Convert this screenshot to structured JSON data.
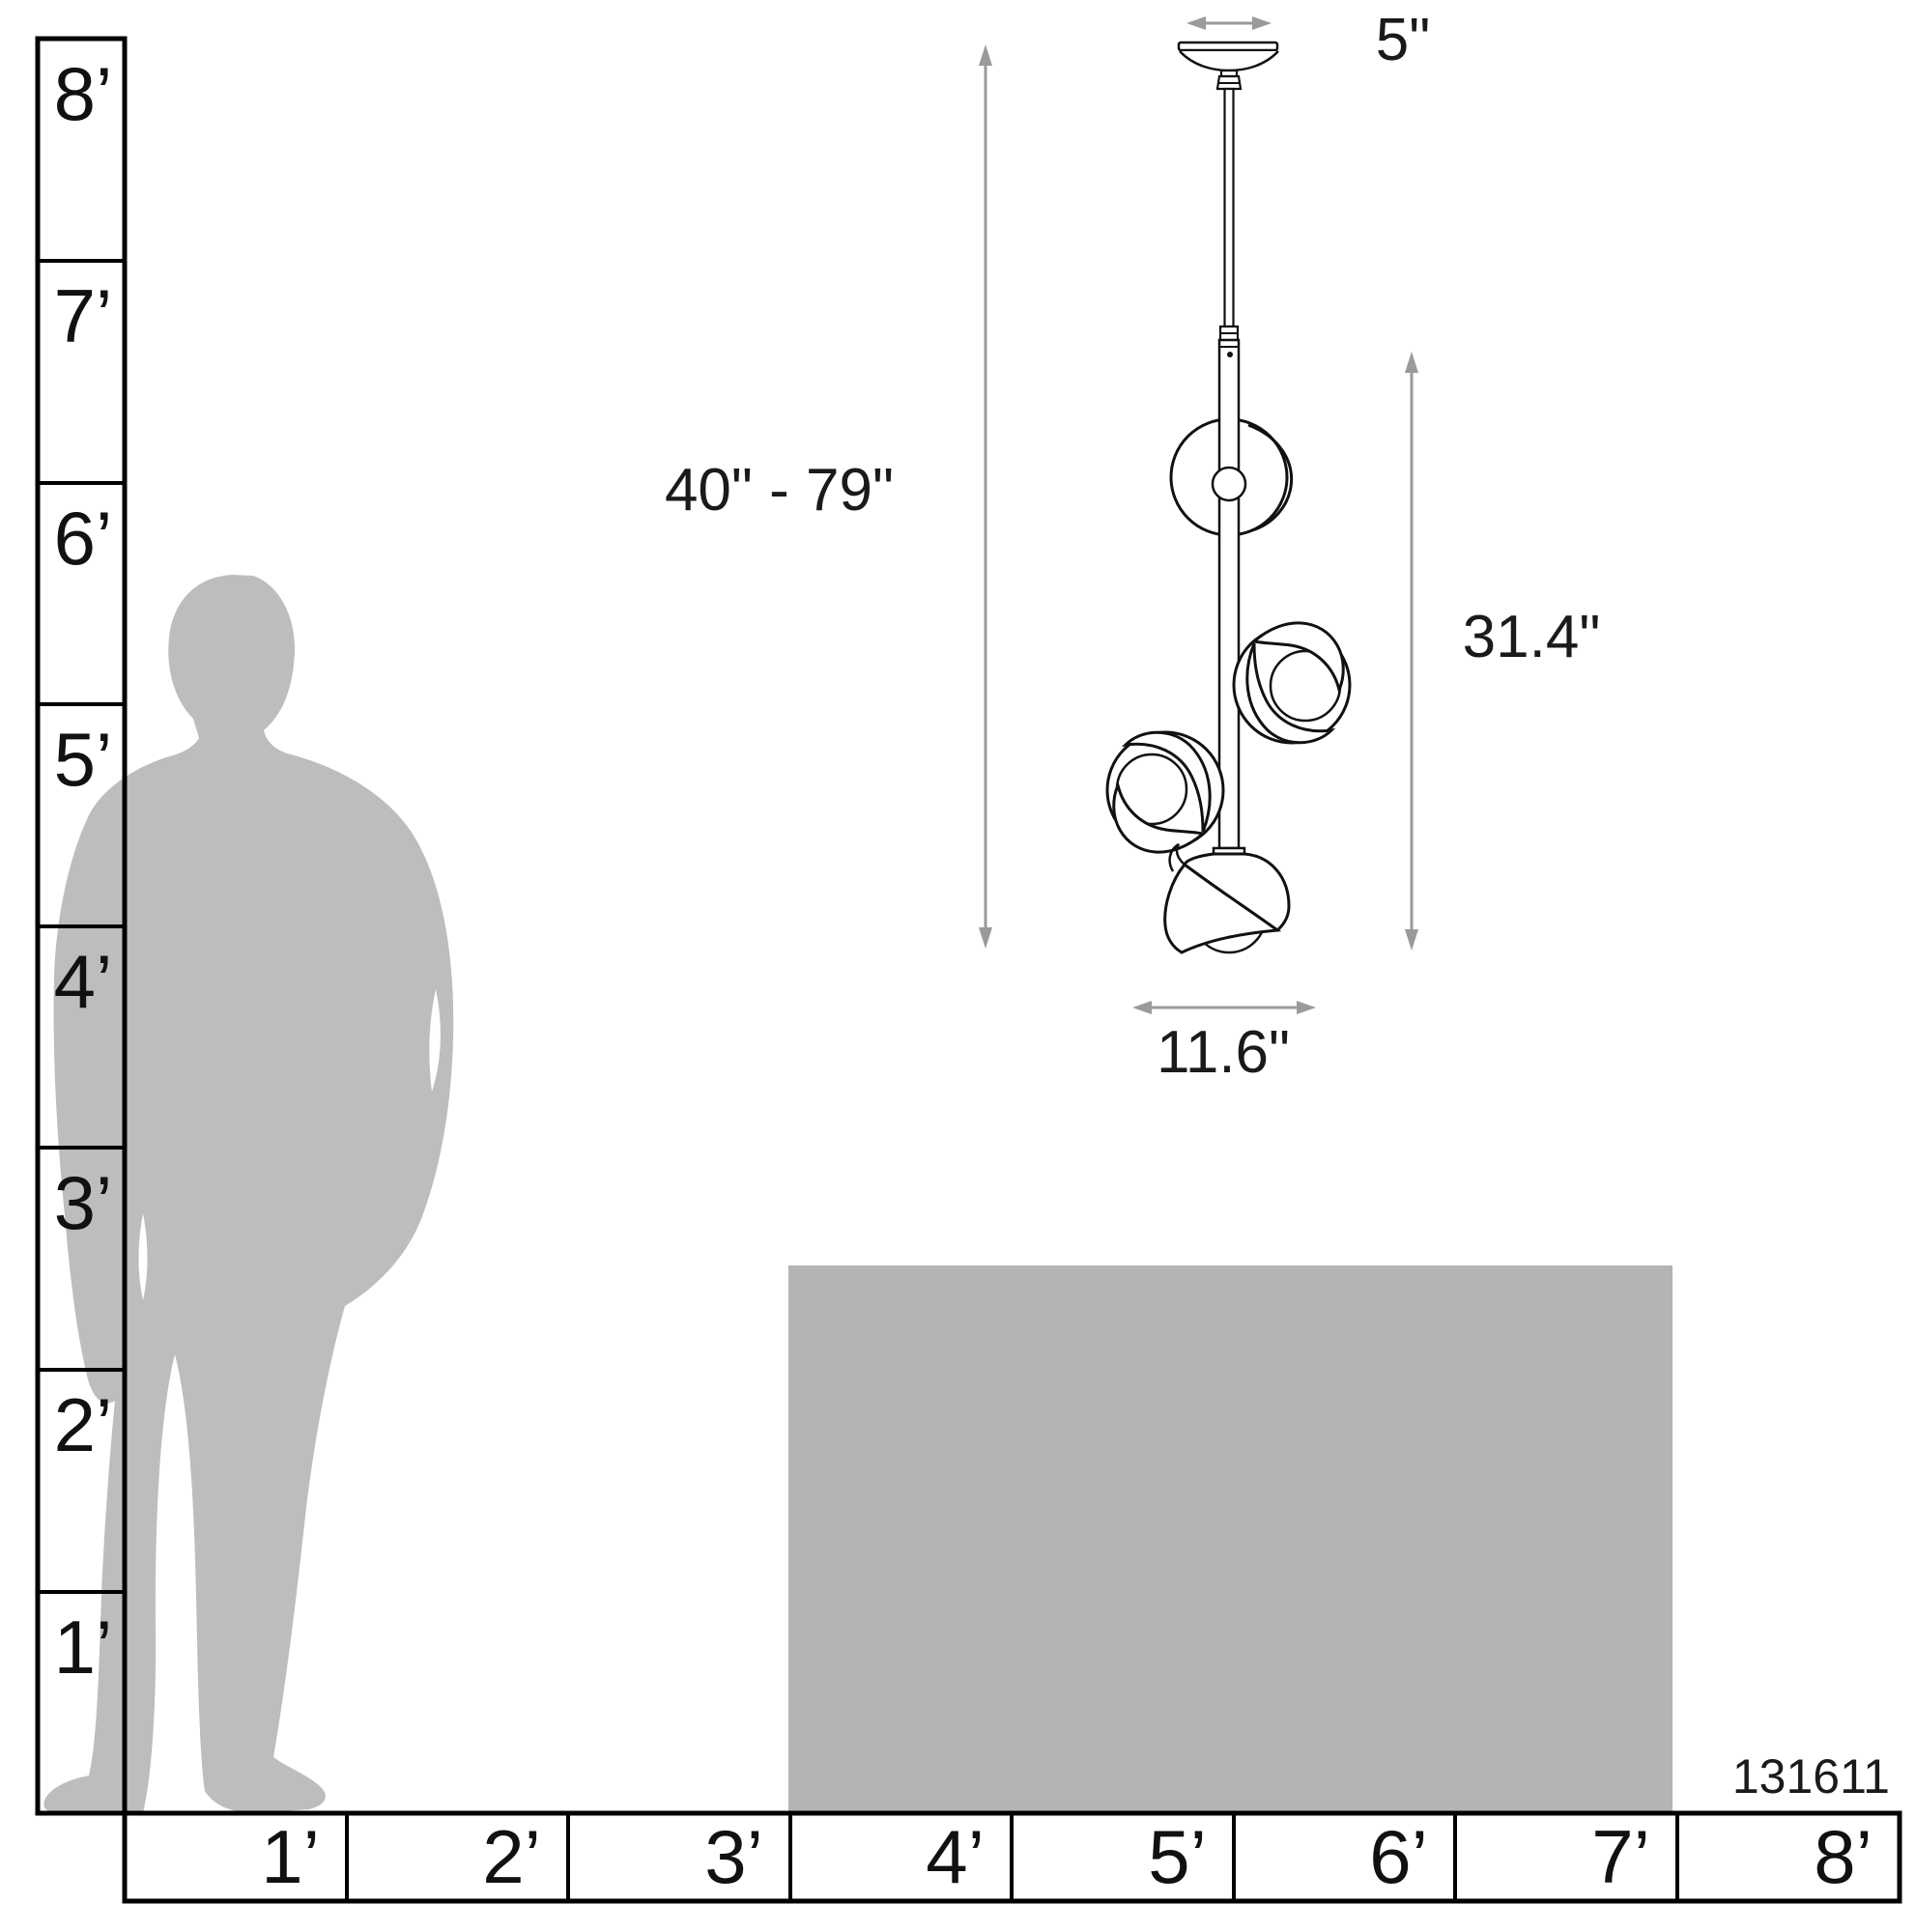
{
  "diagram": {
    "item_number": "131611",
    "dimensions": {
      "canopy_width": "5\"",
      "overall_height_range": "40\" - 79\"",
      "fixture_height": "31.4\"",
      "fixture_width": "11.6\""
    },
    "vertical_ruler_labels": [
      "8’",
      "7’",
      "6’",
      "5’",
      "4’",
      "3’",
      "2’",
      "1’"
    ],
    "horizontal_ruler_labels": [
      "1’",
      "2’",
      "3’",
      "4’",
      "5’",
      "6’",
      "7’",
      "8’"
    ],
    "colors": {
      "line_black": "#000000",
      "fixture_line": "#111111",
      "dimension_gray": "#9a9a9a",
      "text_dark": "#1a1a1a",
      "silhouette_gray": "#bdbdbd",
      "table_gray": "#b4b4b4"
    }
  }
}
